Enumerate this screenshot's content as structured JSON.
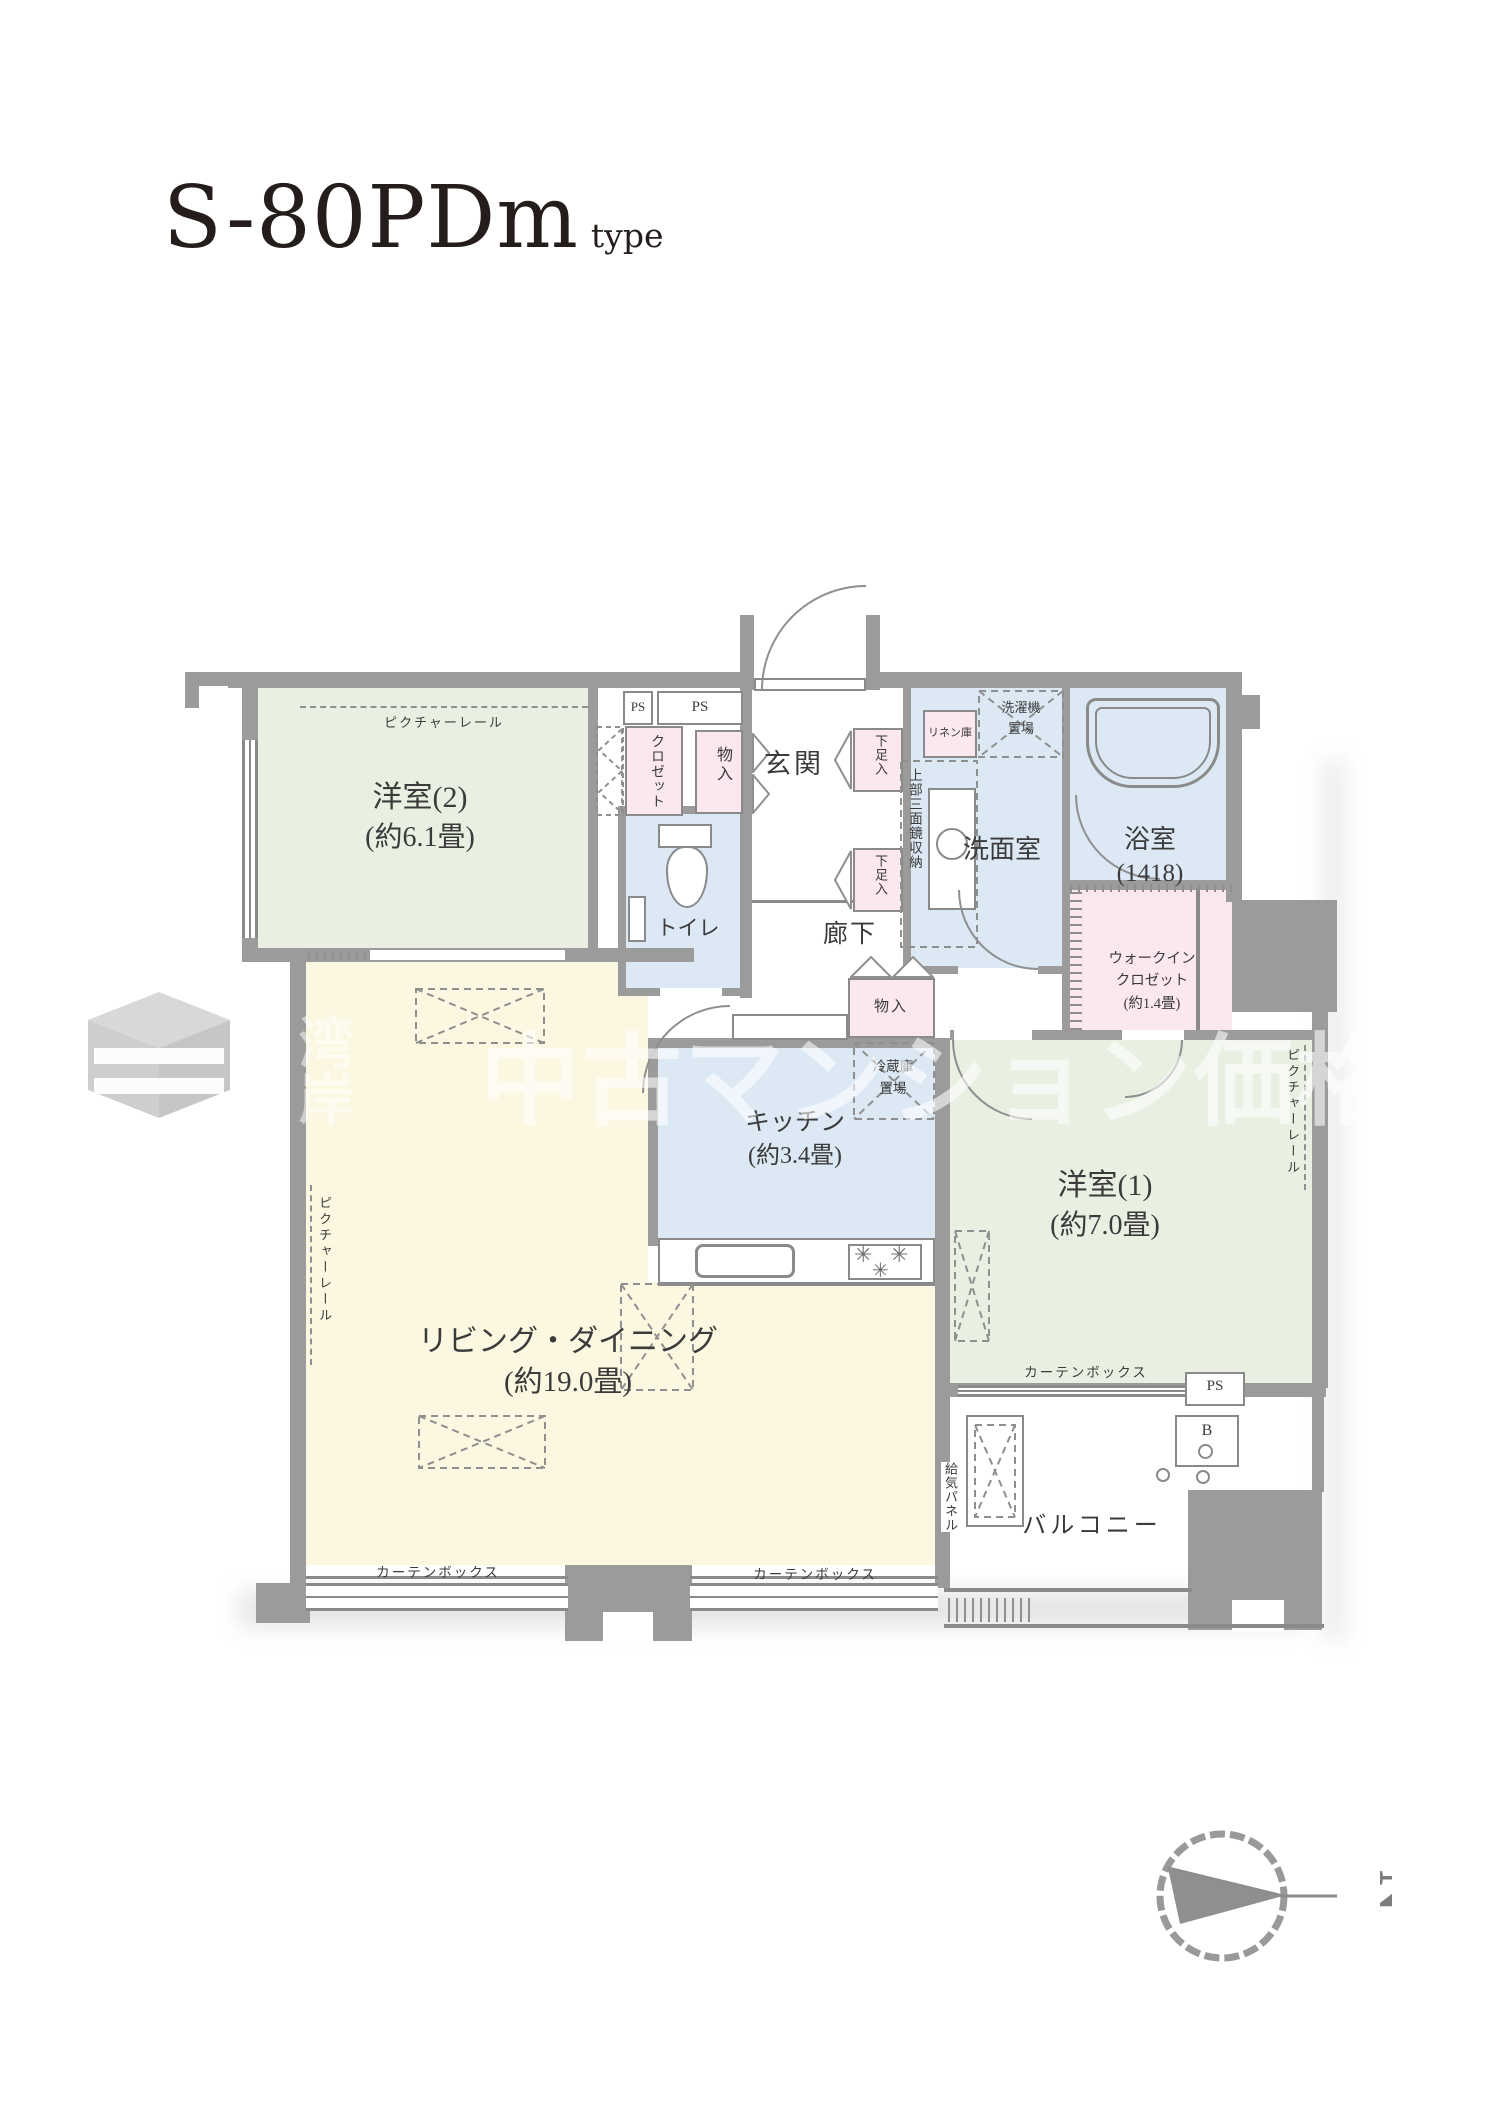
{
  "header": {
    "title": "S-80PDm",
    "title_suffix": "type"
  },
  "rooms": {
    "western2": {
      "name": "洋室(2)",
      "size": "(約6.1畳)"
    },
    "living": {
      "name": "リビング・ダイニング",
      "size": "(約19.0畳)"
    },
    "kitchen": {
      "name": "キッチン",
      "size": "(約3.4畳)"
    },
    "western1": {
      "name": "洋室(1)",
      "size": "(約7.0畳)"
    },
    "bathroom": {
      "name": "浴室",
      "size": "(1418)"
    },
    "washroom": {
      "name": "洗面室"
    },
    "toilet": {
      "name": "トイレ"
    },
    "entrance": {
      "name": "玄関"
    },
    "hallway": {
      "name": "廊下"
    },
    "balcony": {
      "name": "バルコニー"
    },
    "walkin_closet": {
      "line1": "ウォークイン",
      "line2": "クロゼット",
      "line3": "(約1.4畳)"
    }
  },
  "fixtures": {
    "picture_rail": "ピクチャーレール",
    "curtain_box": "カーテンボックス",
    "closet": "クロゼット",
    "storage": "物入",
    "shoe_box": "下足入",
    "linen": "リネン庫",
    "mirror_cabinet": "上部三面鏡収納",
    "washer_line1": "洗濯機",
    "washer_line2": "置場",
    "fridge_line1": "冷蔵庫",
    "fridge_line2": "置場",
    "ps": "PS",
    "air_panel": "給気パネル",
    "b_mark": "B"
  },
  "compass": {
    "north": "N"
  },
  "watermark": {
    "vertical": "湾岸",
    "horizontal": "中古マンション価格ナビ"
  }
}
